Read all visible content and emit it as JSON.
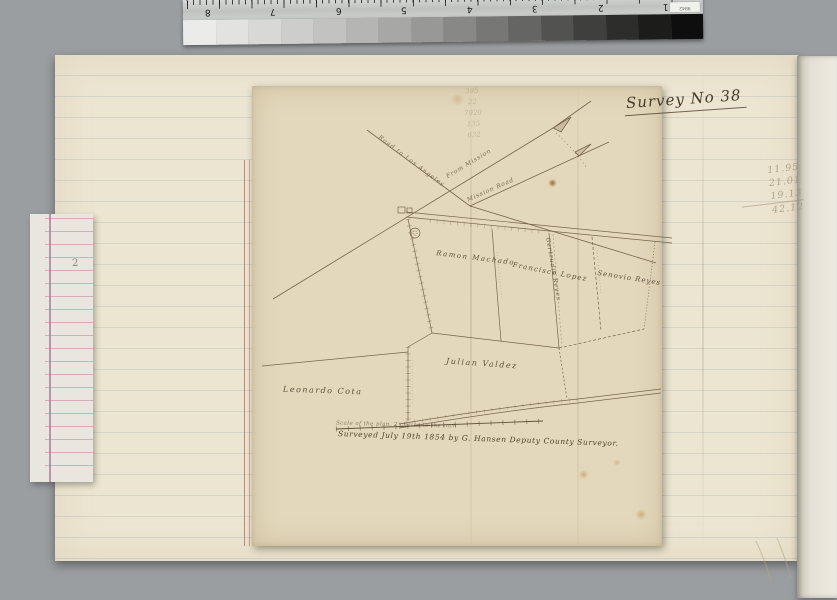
{
  "calibration": {
    "ruler_numbers": [
      "8",
      "7",
      "6",
      "5",
      "4",
      "3",
      "2",
      "1"
    ],
    "ruler_tag": "9842",
    "wedge_steps": [
      "#ebebe9",
      "#e2e2e0",
      "#d8d8d6",
      "#cdcdcb",
      "#c2c2c0",
      "#b5b5b3",
      "#a7a7a5",
      "#989896",
      "#888886",
      "#777775",
      "#656563",
      "#525250",
      "#3f3f3d",
      "#2d2d2b",
      "#1c1c1a",
      "#0e0e0e"
    ]
  },
  "survey": {
    "title": "Survey No 38",
    "roads": {
      "road_to_los_angeles": "Road to Los Angeles",
      "from_mission": "From Mission",
      "mission_road": "Mission Road"
    },
    "parcels": {
      "machado": "Ramon Machado",
      "lopez": "Francisco Lopez",
      "gertrudis": "Gertrudis Reyes",
      "reyes": "Senovio Reyes",
      "valdez": "Julian Valdez",
      "cota": "Leonardo Cota"
    },
    "footer": {
      "scale_note": "Scale of the plan, 2 chains to the inch",
      "surveyed_line": "Surveyed July 19th 1854 by G. Hansen Deputy County Surveyor."
    }
  },
  "pencil_notes": {
    "top_column": [
      "395",
      "22",
      "7920",
      "135",
      "632"
    ],
    "right_column": [
      "11.95",
      "21.01",
      "19.13",
      "42.12"
    ]
  },
  "ledger": {
    "page_number": "2"
  },
  "colors": {
    "background": "#9b9ea1",
    "album_page": "#ece5d1",
    "map_sheet": "#e3d8bc",
    "ink": "#5c4b36",
    "pencil": "#a39476",
    "margin_red": "#a8523e",
    "ledger_pink": "#c46e92",
    "ledger_purple": "#8c5082"
  }
}
